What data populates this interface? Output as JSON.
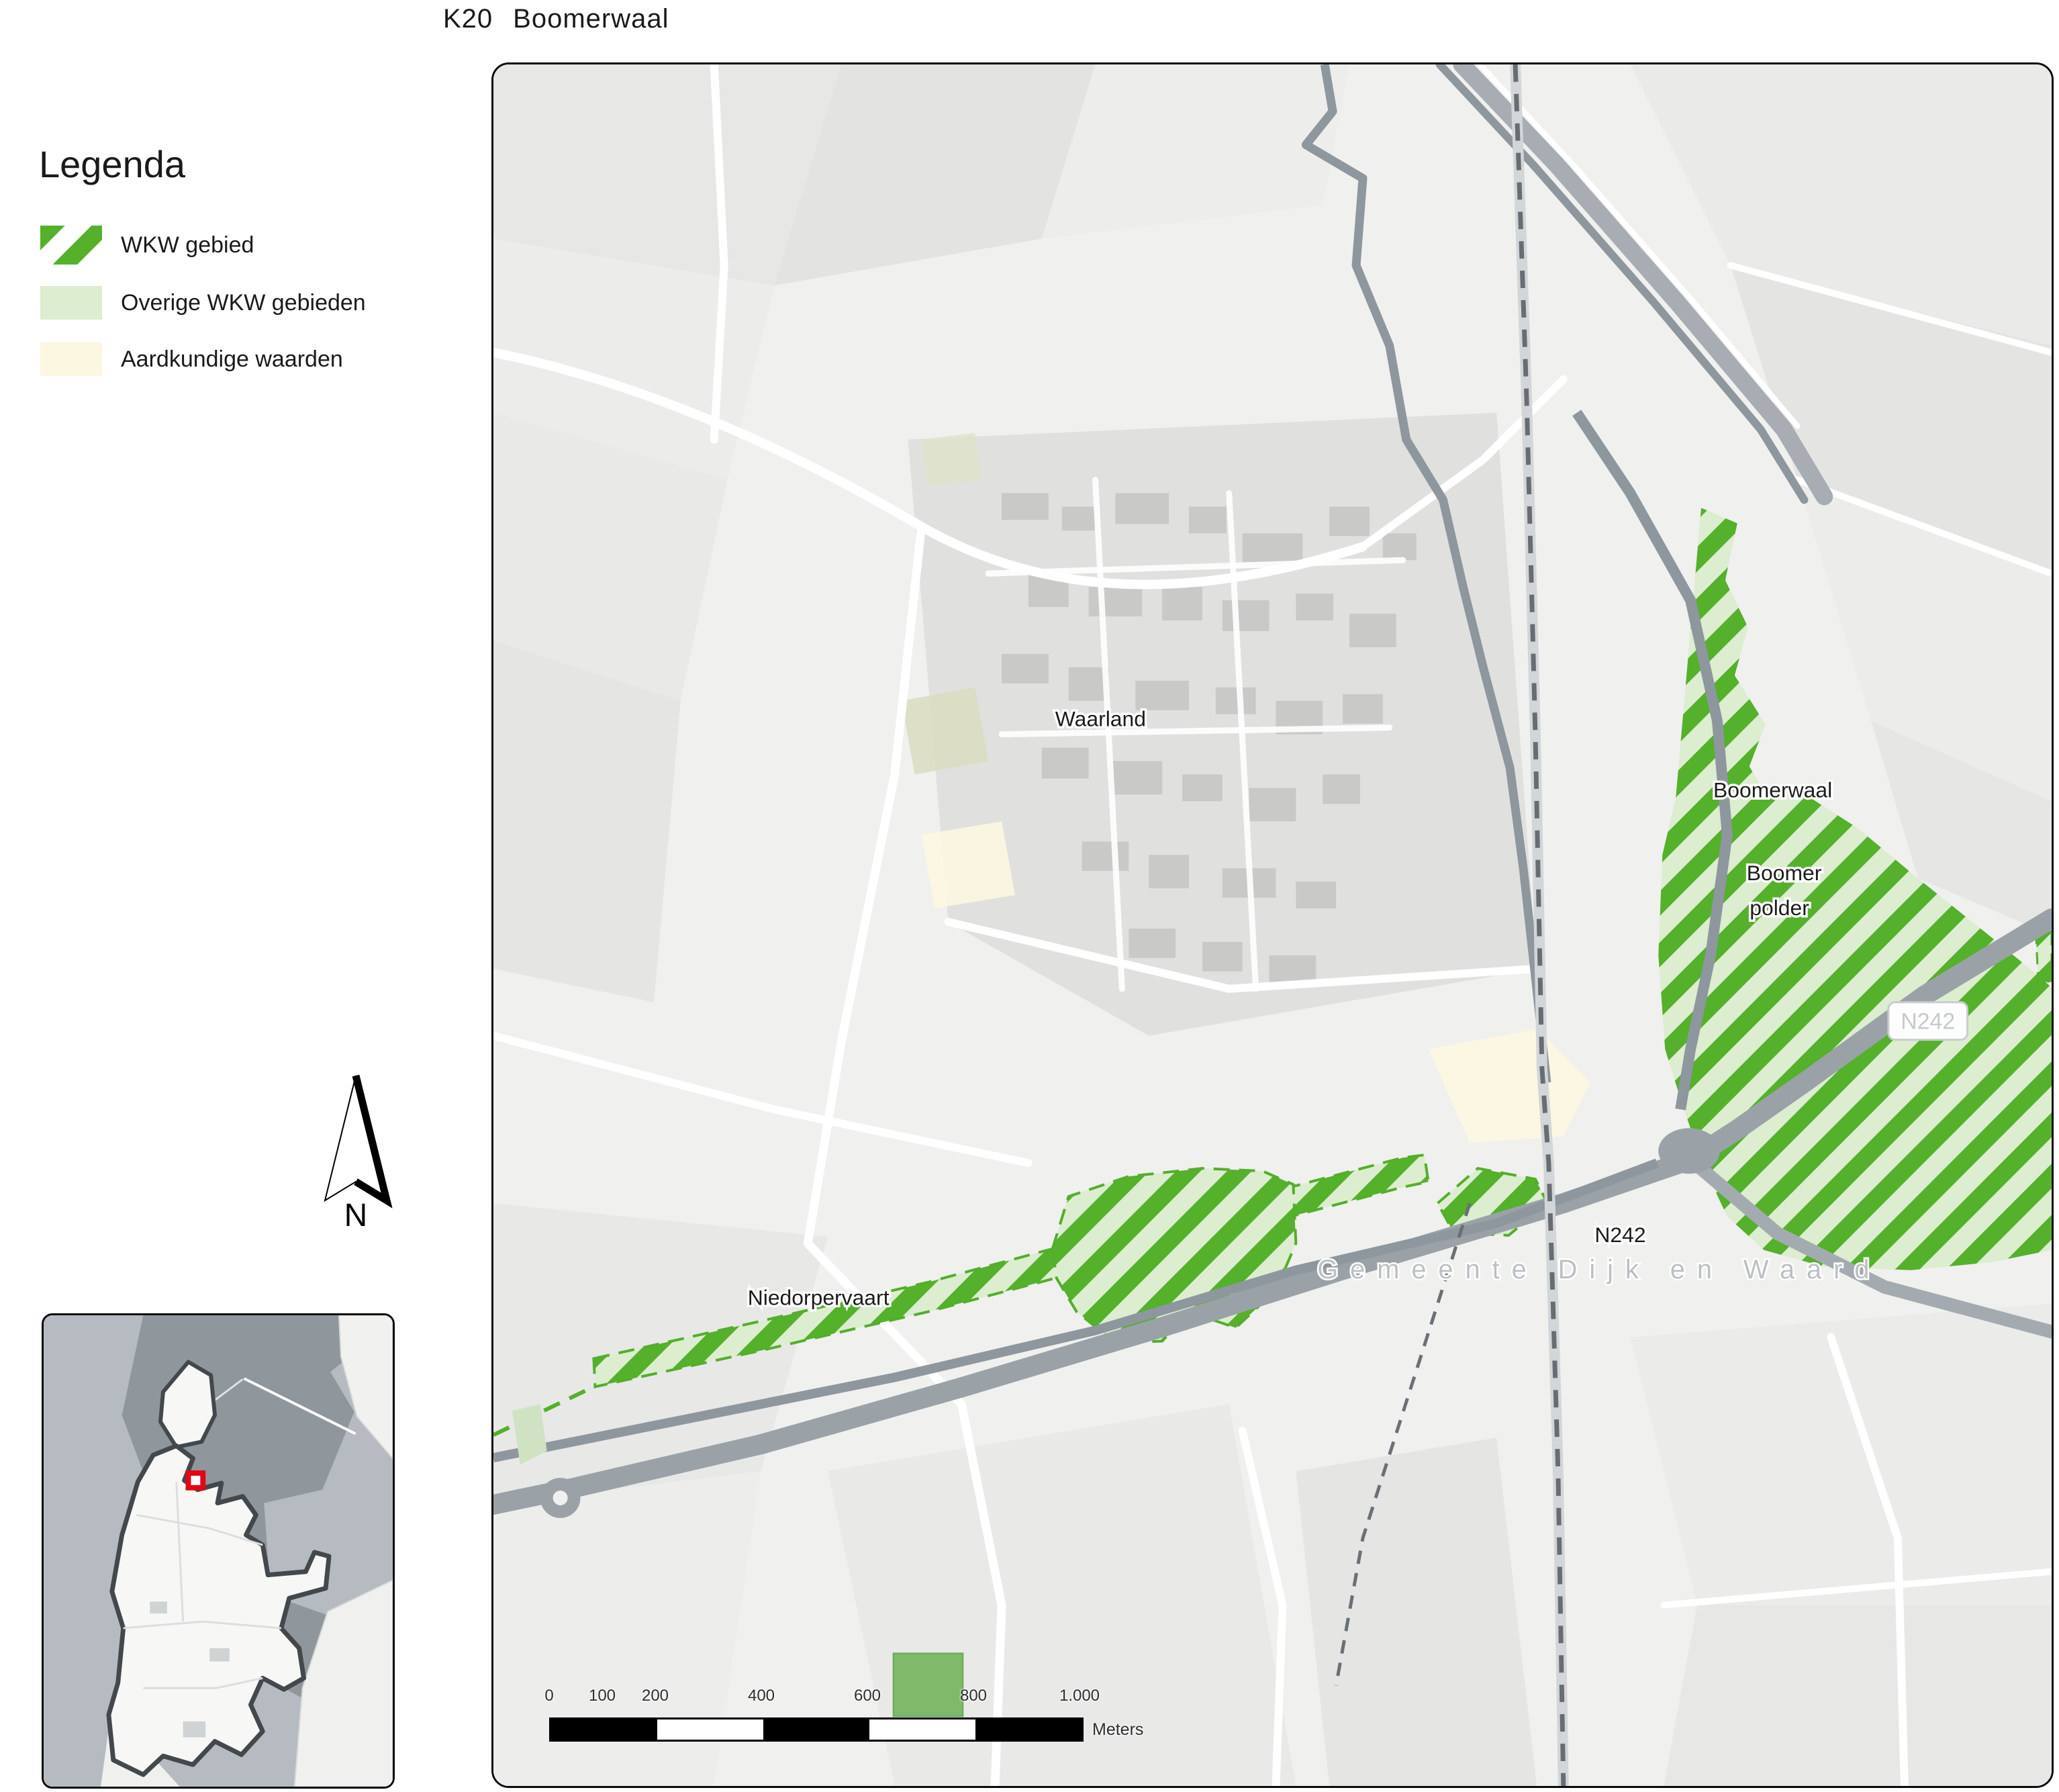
{
  "title": {
    "code": "K20",
    "name": "Boomerwaal"
  },
  "legend": {
    "heading": "Legenda",
    "items": [
      {
        "label": "WKW gebied",
        "swatch": "green-diagonal-hatch"
      },
      {
        "label": "Overige WKW gebieden",
        "swatch": "light-green-fill"
      },
      {
        "label": "Aardkundige waarden",
        "swatch": "cream-fill"
      }
    ]
  },
  "north_arrow_label": "N",
  "map_labels": {
    "town": "Waarland",
    "wkw_area": "Boomerwaal",
    "polder_line1": "Boomer",
    "polder_line2": "polder",
    "road_shield": "N242",
    "road": "N242",
    "canal": "Niedorpervaart",
    "municipality": "Gemeente Dijk en Waard"
  },
  "scale_bar": {
    "ticks": [
      "0",
      "100",
      "200",
      "400",
      "600",
      "800",
      "1.000"
    ],
    "unit": "Meters"
  },
  "colors": {
    "wkw_green": "#55b02c",
    "wkw_light_green": "#dcedd0",
    "aardkundig_cream": "#fcf7e0",
    "locator_red": "#e30613",
    "water_gray": "#8e979e",
    "road_gray": "#9aa2a8"
  }
}
